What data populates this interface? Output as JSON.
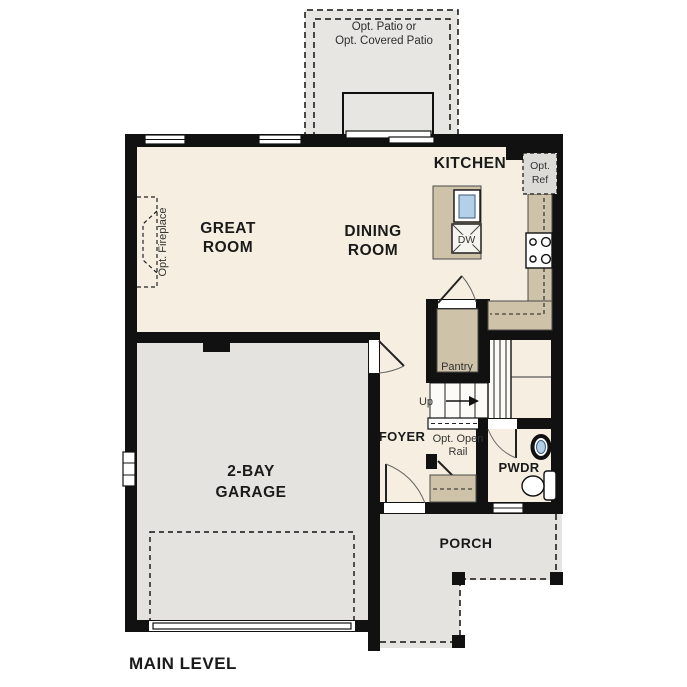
{
  "plan": {
    "title": "MAIN LEVEL"
  },
  "rooms": {
    "great_room": {
      "line1": "GREAT",
      "line2": "ROOM"
    },
    "dining_room": {
      "line1": "DINING",
      "line2": "ROOM"
    },
    "kitchen": {
      "label": "KITCHEN"
    },
    "garage": {
      "line1": "2-BAY",
      "line2": "GARAGE"
    },
    "foyer": {
      "label": "FOYER"
    },
    "powder": {
      "label": "PWDR"
    },
    "porch": {
      "label": "PORCH"
    },
    "pantry": {
      "label": "Pantry"
    }
  },
  "options": {
    "patio": {
      "line1": "Opt. Patio or",
      "line2": "Opt. Covered Patio"
    },
    "fireplace": {
      "label": "Opt. Fireplace"
    },
    "refrigerator": {
      "line1": "Opt.",
      "line2": "Ref"
    },
    "open_rail": {
      "line1": "Opt. Open",
      "line2": "Rail"
    }
  },
  "stairs": {
    "up_label": "Up"
  },
  "appliances": {
    "dishwasher_label": "DW"
  },
  "colors": {
    "wall": "#111111",
    "floor_cream": "#f6efe1",
    "concrete_gray": "#e4e3e0",
    "casework_tan": "#cec2a8",
    "fixture_blue": "#b3d0e8",
    "optional_gray": "#dcdbd8"
  }
}
